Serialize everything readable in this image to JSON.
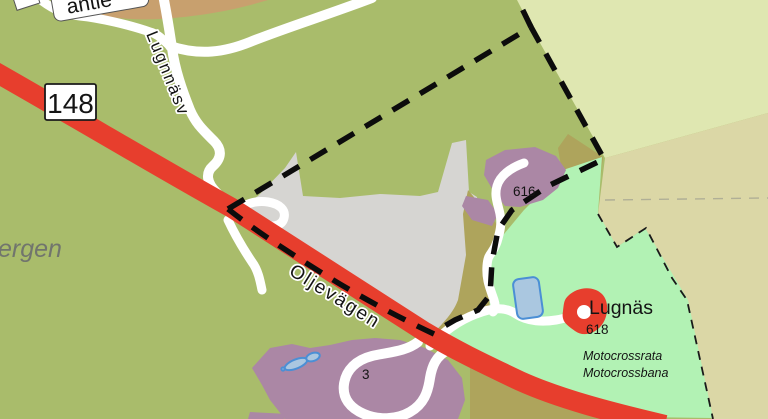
{
  "map": {
    "labels": {
      "road_shield": "148",
      "top_road_name": "antie",
      "top_road_number": "25",
      "left_road_name": "Lugnnäsv",
      "left_area_name": "ergen",
      "main_road_name": "Oljevägen",
      "parcel_616": "616",
      "place_name": "Lugnäs",
      "parcel_618": "618",
      "note_line1": "Motocrossrata",
      "note_line2": "Motocrossbana",
      "parcel_3": "3"
    },
    "features": {
      "main_road": "highway-148-oljevagen",
      "boundary": "thick-dashed-property-boundary",
      "quarry": "gray-open-area",
      "motocross": "light-green-motocross-area",
      "ponds": "blue-ponds",
      "poi_marker": "red-building-marker-lugnas"
    },
    "colors": {
      "bg-olive": "#a9bc6b",
      "tan": "#c8a06e",
      "pale-green": "#dfe7b1",
      "pale-tan": "#dbd7a6",
      "light-green": "#b2f2b4",
      "gray": "#d6d5d2",
      "olive-dark": "#aea45c",
      "purple": "#ab87a5",
      "road-red": "#e73e2d",
      "road-white": "#ffffff",
      "pond-fill": "#aac7e0",
      "pond-stroke": "#4b8fd5",
      "boundary": "#0c0c0c",
      "boundary-thin": "#1a1a1a",
      "faint-line": "#9a9a8e",
      "text-dark": "#141414",
      "text-gray": "#71756d",
      "label-red": "#b3332a"
    }
  }
}
